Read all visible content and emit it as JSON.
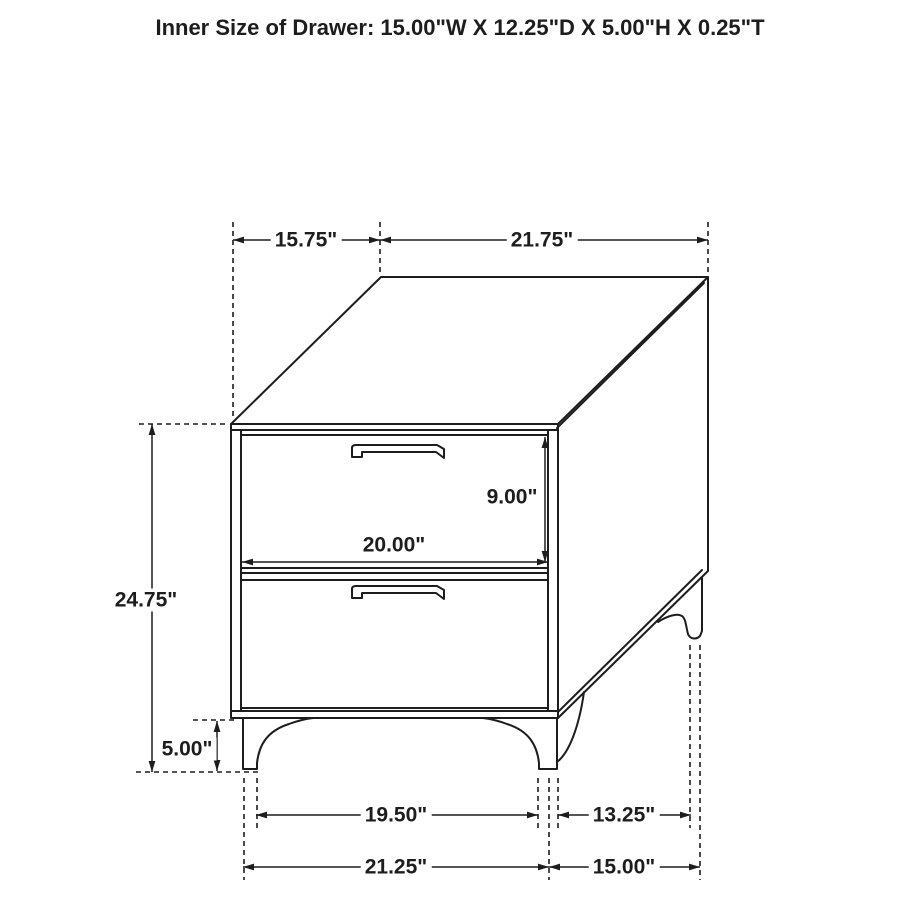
{
  "title": "Inner Size of Drawer: 15.00\"W X 12.25\"D X 5.00\"H X 0.25\"T",
  "dimensions": {
    "top_depth": "15.75\"",
    "top_width": "21.75\"",
    "overall_height": "24.75\"",
    "drawer_face_height": "9.00\"",
    "drawer_face_width": "20.00\"",
    "leg_height": "5.00\"",
    "front_feet_inner_span": "19.50\"",
    "side_feet_inner_span": "13.25\"",
    "front_feet_outer_span": "21.25\"",
    "side_feet_outer_span": "15.00\""
  },
  "colors": {
    "line": "#1d1d1d",
    "background": "#ffffff"
  }
}
